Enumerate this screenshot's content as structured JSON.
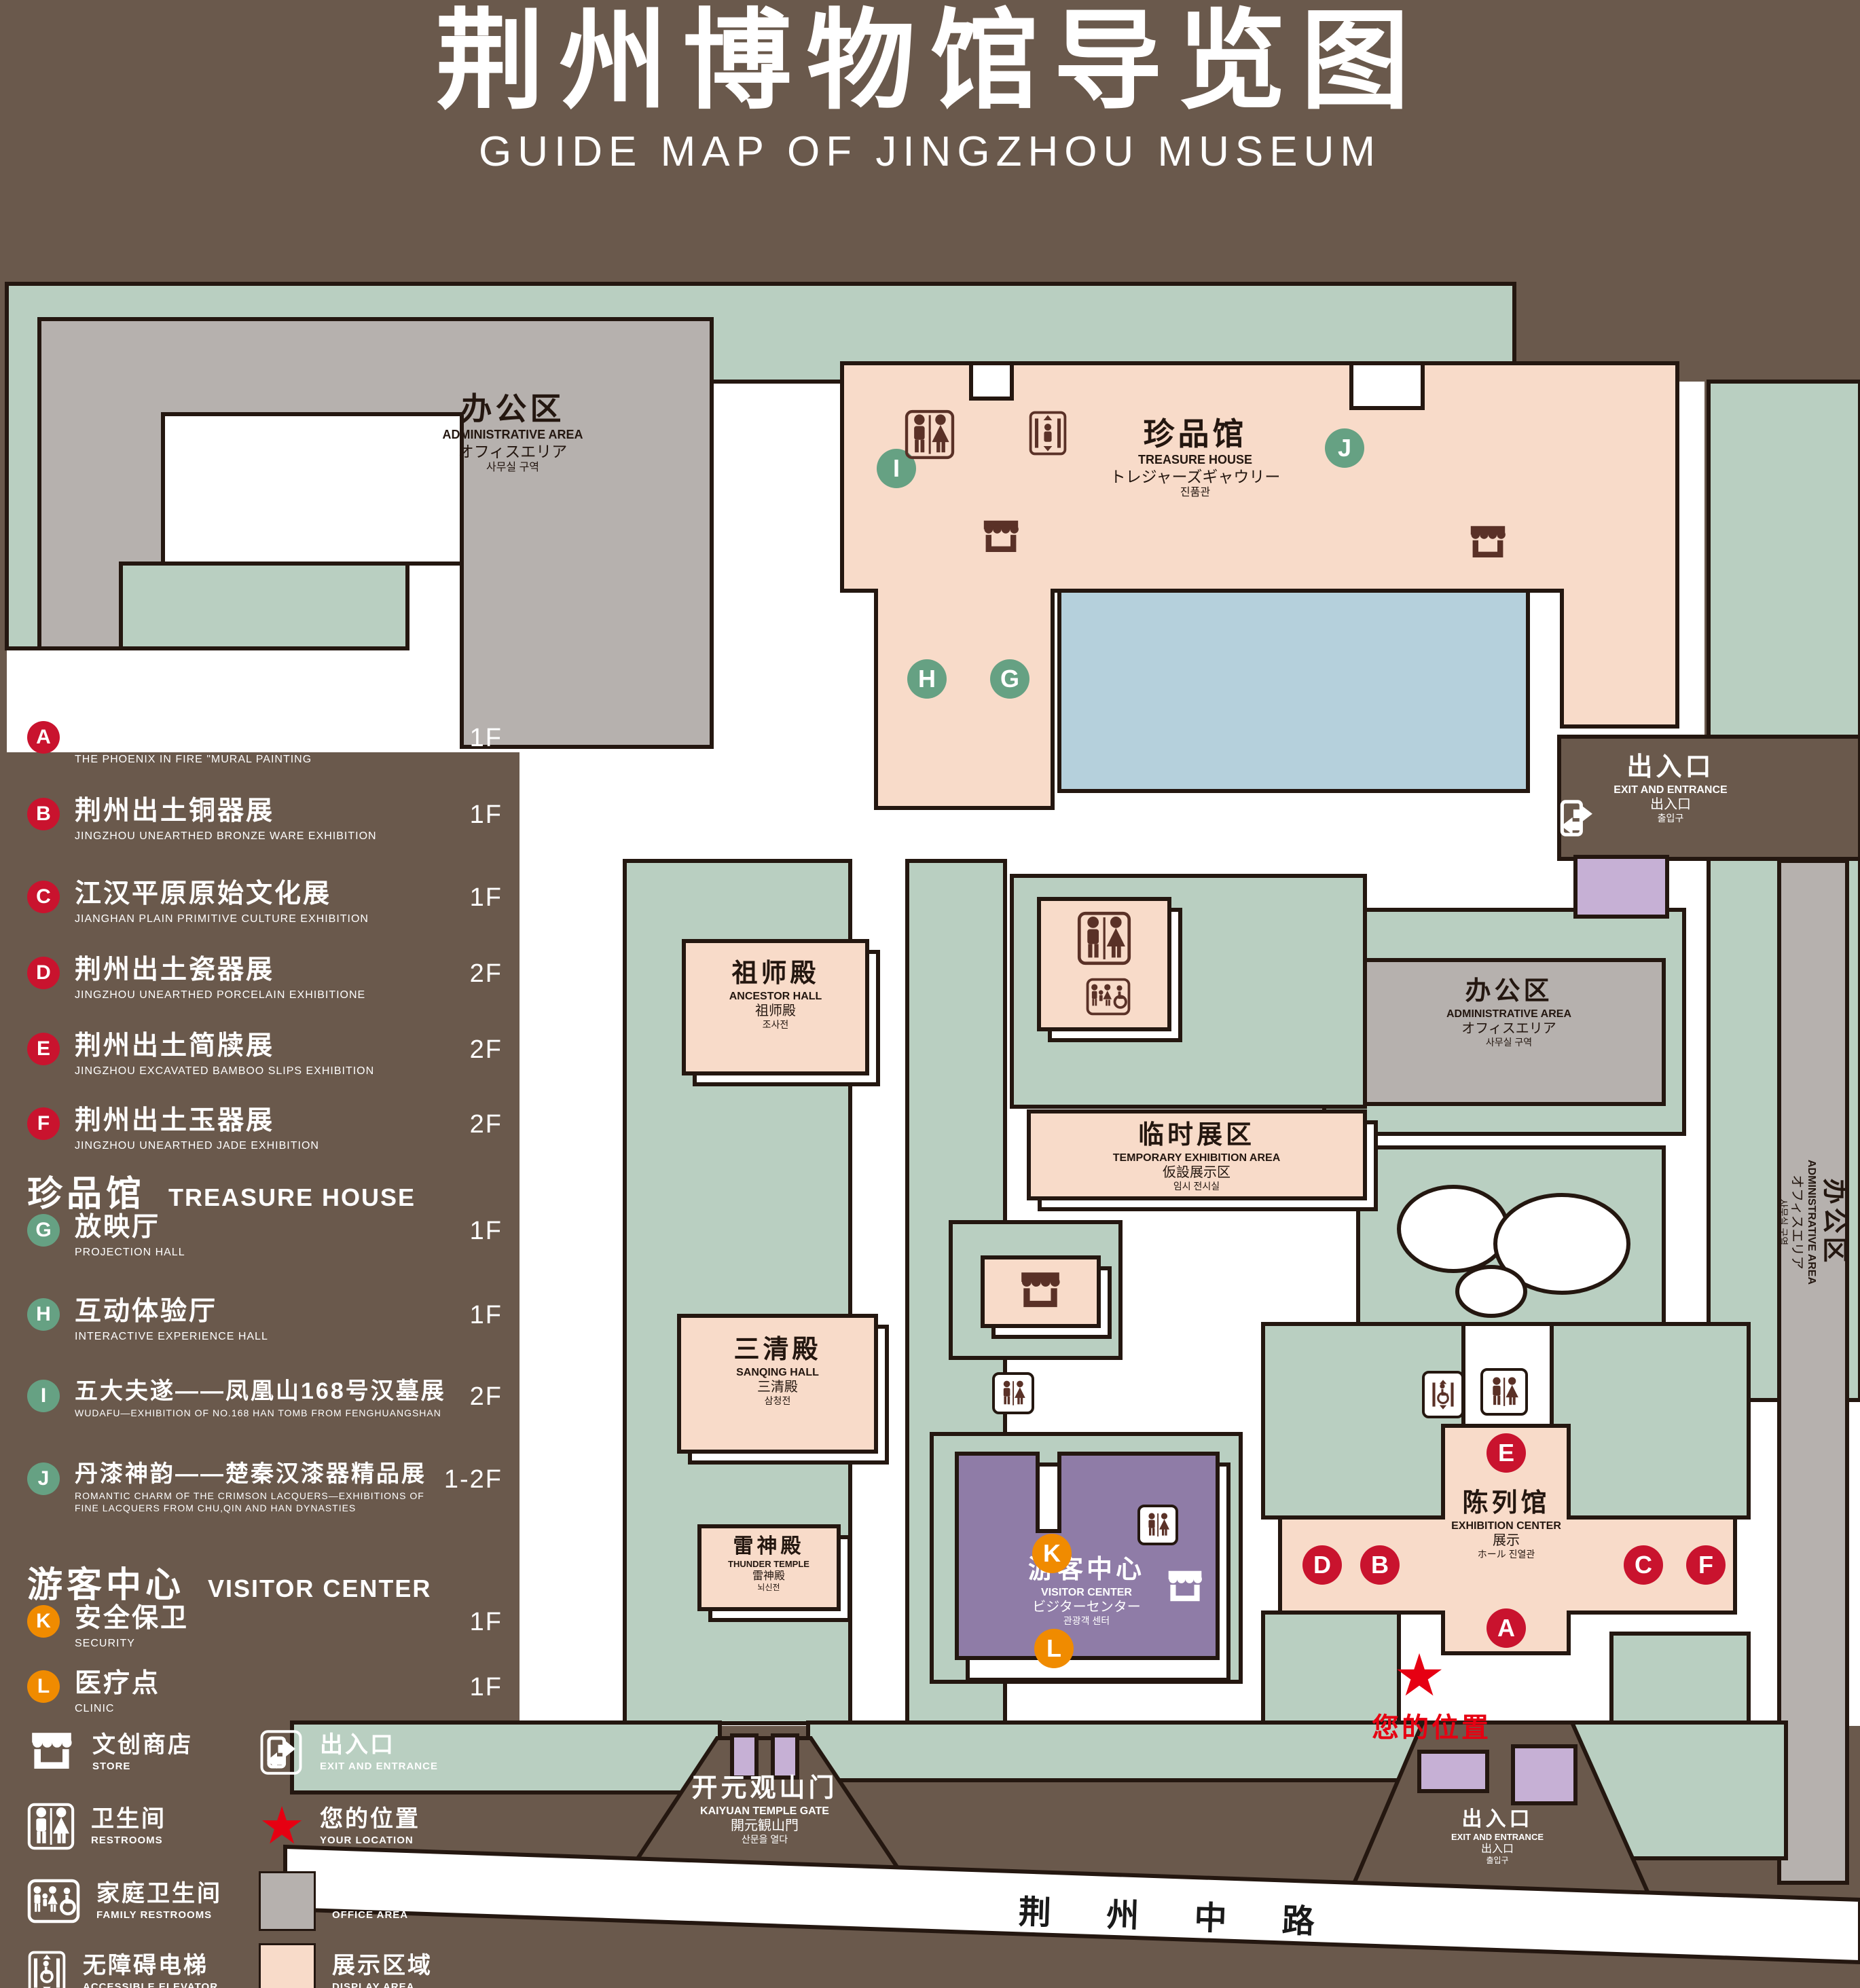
{
  "title": {
    "zh": "荆州博物馆导览图",
    "en": "GUIDE MAP OF JINGZHOU MUSEUM"
  },
  "legend": {
    "sections": [
      {
        "zh": "陈列馆",
        "en": "EXHIBITION CENTER",
        "items": [
          {
            "letter": "A",
            "zh": "《火中的凤凰》壁画",
            "en": "THE PHOENIX IN FIRE \"MURAL PAINTING",
            "floor": "1F"
          },
          {
            "letter": "B",
            "zh": "荆州出土铜器展",
            "en": "JINGZHOU UNEARTHED BRONZE WARE EXHIBITION",
            "floor": "1F"
          },
          {
            "letter": "C",
            "zh": "江汉平原原始文化展",
            "en": "JIANGHAN PLAIN PRIMITIVE CULTURE EXHIBITION",
            "floor": "1F"
          },
          {
            "letter": "D",
            "zh": "荆州出土瓷器展",
            "en": "JINGZHOU UNEARTHED PORCELAIN EXHIBITIONE",
            "floor": "2F"
          },
          {
            "letter": "E",
            "zh": "荆州出土简牍展",
            "en": "JINGZHOU EXCAVATED BAMBOO SLIPS EXHIBITION",
            "floor": "2F"
          },
          {
            "letter": "F",
            "zh": "荆州出土玉器展",
            "en": "JINGZHOU UNEARTHED JADE EXHIBITION",
            "floor": "2F"
          }
        ]
      },
      {
        "zh": "珍品馆",
        "en": "TREASURE HOUSE",
        "items": [
          {
            "letter": "G",
            "zh": "放映厅",
            "en": "PROJECTION HALL",
            "floor": "1F"
          },
          {
            "letter": "H",
            "zh": "互动体验厅",
            "en": "INTERACTIVE EXPERIENCE HALL",
            "floor": "1F"
          },
          {
            "letter": "I",
            "zh": "五大夫遂——凤凰山168号汉墓展",
            "en": "WUDAFU—EXHIBITION OF NO.168 HAN TOMB FROM FENGHUANGSHAN",
            "floor": "2F"
          },
          {
            "letter": "J",
            "zh": "丹漆神韵——楚秦汉漆器精品展",
            "en": "ROMANTIC CHARM OF THE CRIMSON LACQUERS—EXHIBITIONS OF FINE LACQUERS FROM CHU,QIN AND HAN DYNASTIES",
            "floor": "1-2F"
          }
        ]
      },
      {
        "zh": "游客中心",
        "en": "VISITOR CENTER",
        "items": [
          {
            "letter": "K",
            "zh": "安全保卫",
            "en": "SECURITY",
            "floor": "1F"
          },
          {
            "letter": "L",
            "zh": "医疗点",
            "en": "CLINIC",
            "floor": "1F"
          }
        ]
      }
    ],
    "symbols": [
      {
        "icon": "store-icon",
        "zh": "文创商店",
        "en": "STORE"
      },
      {
        "icon": "exit-icon",
        "zh": "出入口",
        "en": "EXIT AND ENTRANCE"
      },
      {
        "icon": "restrooms-icon",
        "zh": "卫生间",
        "en": "RESTROOMS"
      },
      {
        "icon": "your-location-icon",
        "zh": "您的位置",
        "en": "YOUR LOCATION"
      },
      {
        "icon": "family-restrooms-icon",
        "zh": "家庭卫生间",
        "en": "FAMILY RESTROOMS"
      },
      {
        "icon": "office-area-swatch",
        "zh": "办公区域",
        "en": "OFFICE AREA"
      },
      {
        "icon": "accessible-elevator-icon",
        "zh": "无障碍电梯",
        "en": "ACCESSIBLE ELEVATOR"
      },
      {
        "icon": "display-area-swatch",
        "zh": "展示区域",
        "en": "DISPLAY AREA"
      },
      {
        "icon": "elevator-icon",
        "zh": "电梯",
        "en": "Elevator"
      }
    ]
  },
  "map": {
    "admin_area": {
      "zh": "办公区",
      "en": "ADMINISTRATIVE AREA",
      "jp": "オフィスエリア",
      "kr": "사무실 구역"
    },
    "treasure_house": {
      "zh": "珍品馆",
      "en": "TREASURE HOUSE",
      "jp": "トレジャーズギャウリー",
      "kr": "진품관"
    },
    "exit": {
      "zh": "出入口",
      "en": "EXIT AND ENTRANCE",
      "jp": "出入口",
      "kr": "출입구"
    },
    "ancestor_hall": {
      "zh": "祖师殿",
      "en": "ANCESTOR HALL",
      "jp": "祖师殿",
      "kr": "조사전"
    },
    "sanqing_hall": {
      "zh": "三清殿",
      "en": "SANQING HALL",
      "jp": "三清殿",
      "kr": "삼청전"
    },
    "thunder_temple": {
      "zh": "雷神殿",
      "en": "THUNDER TEMPLE",
      "jp": "雷神殿",
      "kr": "뇌신전"
    },
    "temporary_area": {
      "zh": "临时展区",
      "en": "TEMPORARY EXHIBITION AREA",
      "jp": "仮設展示区",
      "kr": "임시 전시실"
    },
    "exhibition_center": {
      "zh": "陈列馆",
      "en": "EXHIBITION CENTER",
      "jp": "展示",
      "kr": "ホール 진열관"
    },
    "visitor_center": {
      "zh": "游客中心",
      "en": "VISITOR CENTER",
      "jp": "ビジターセンター",
      "kr": "관광객 센터"
    },
    "gate": {
      "zh": "开元观山门",
      "en": "KAIYUAN TEMPLE GATE",
      "jp": "開元観山門",
      "kr": "산문을 열다"
    },
    "your_location": "您的位置",
    "road": "荆 州 中 路",
    "badges": {
      "a": "A",
      "b": "B",
      "c": "C",
      "d": "D",
      "e": "E",
      "f": "F",
      "g": "G",
      "h": "H",
      "i": "I",
      "j": "J",
      "k": "K",
      "l": "L"
    }
  },
  "colors": {
    "background": "#6a594c",
    "landscape_green": "#b9cfc1",
    "display_pink": "#f8dbc9",
    "office_gray": "#b6b1ae",
    "water_blue": "#b5d0dc",
    "visitor_purple": "#8f7ca7",
    "booth_purple": "#c6b0d5",
    "badge_red": "#c9132e",
    "badge_green": "#66a183",
    "badge_orange": "#f08b00",
    "location_red": "#e60012",
    "outline": "#241710"
  }
}
